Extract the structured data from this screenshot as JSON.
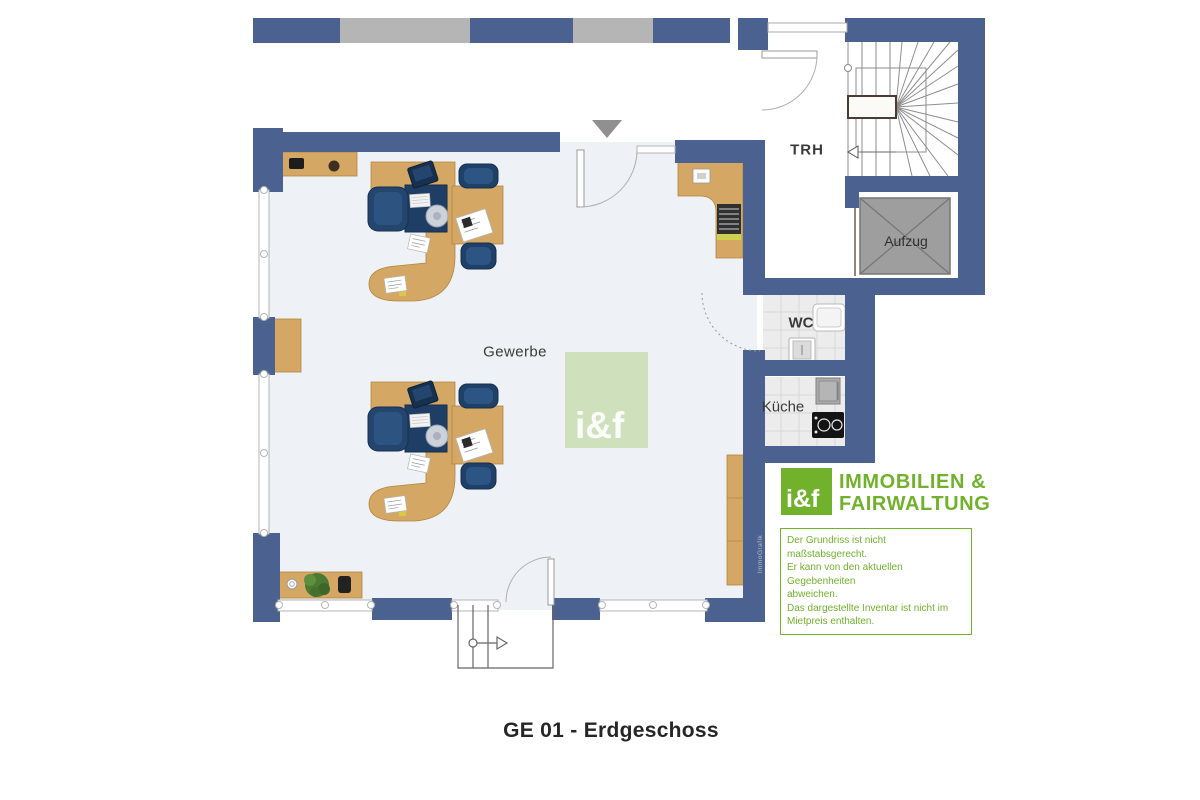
{
  "title": "GE 01 - Erdgeschoss",
  "labels": {
    "main_room": "Gewerbe",
    "stairwell": "TRH",
    "elevator": "Aufzug",
    "wc": "WC",
    "kitchen": "Küche"
  },
  "watermark": {
    "center_logo": "i&f",
    "wall_text": "ImmoGrafik"
  },
  "branding": {
    "logo_mark": "i&f",
    "name_line1": "IMMOBILIEN &",
    "name_line2": "FAIRWALTUNG"
  },
  "disclaimer": {
    "line1": "Der Grundriss ist nicht maßstabsgerecht.",
    "line2": "Er kann von den aktuellen Gegebenheiten",
    "line3": "abweichen.",
    "line4": "Das dargestellte Inventar ist nicht im",
    "line5": "Mietpreis enthalten."
  },
  "colors": {
    "wall_blue": "#4b6290",
    "window_gray": "#b5b5b5",
    "floor": "#eef1f5",
    "wood": "#d5a765",
    "furniture_navy": "#1e3e65",
    "brand_green": "#72b12c",
    "watermark_green": "rgba(182,209,140,0.55)",
    "elevator_gray": "#9e9e9e"
  }
}
